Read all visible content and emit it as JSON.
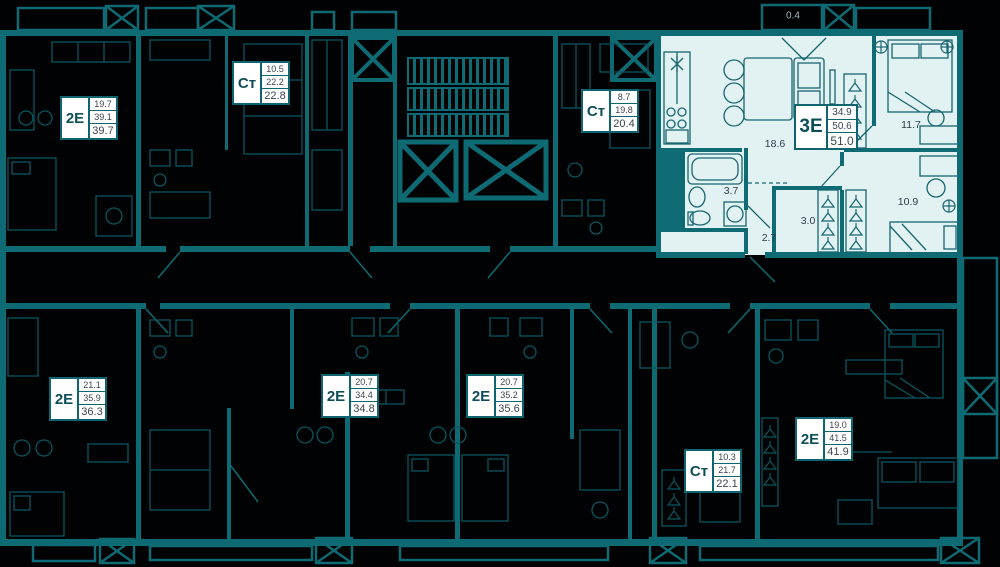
{
  "colors": {
    "background": "#000204",
    "wall_teal": "#0e6b74",
    "dim_teal": "#0b5660",
    "highlight_fill": "#e2f1f2",
    "highlight_stroke": "#176671",
    "label_border": "#0e6570",
    "label_type_text": "#0c4e58",
    "label_value_text": "#3a4650",
    "room_text": "#2e3c49",
    "balcony_text": "#9fb9bd"
  },
  "apartments": [
    {
      "type": "2Е",
      "area_room": "19.7",
      "area_living": "39.1",
      "area_total": "39.7"
    },
    {
      "type": "Ст",
      "area_room": "10.5",
      "area_living": "22.2",
      "area_total": "22.8"
    },
    {
      "type": "Ст",
      "area_room": "8.7",
      "area_living": "19.8",
      "area_total": "20.4"
    },
    {
      "type": "3Е",
      "area_room": "34.9",
      "area_living": "50.6",
      "area_total": "51.0",
      "highlighted": true
    },
    {
      "type": "2Е",
      "area_room": "21.1",
      "area_living": "35.9",
      "area_total": "36.3"
    },
    {
      "type": "2Е",
      "area_room": "20.7",
      "area_living": "34.4",
      "area_total": "34.8"
    },
    {
      "type": "2Е",
      "area_room": "20.7",
      "area_living": "35.2",
      "area_total": "35.6"
    },
    {
      "type": "Ст",
      "area_room": "10.3",
      "area_living": "21.7",
      "area_total": "22.1"
    },
    {
      "type": "2Е",
      "area_room": "19.0",
      "area_living": "41.5",
      "area_total": "41.9"
    }
  ],
  "highlighted_apartment": {
    "type": "3Е",
    "rooms": {
      "balcony": "0.4",
      "kitchen_living": "18.6",
      "bedroom_1": "11.7",
      "bathroom": "3.7",
      "wardrobe": "3.0",
      "hall": "2.7",
      "bedroom_2": "10.9"
    }
  }
}
